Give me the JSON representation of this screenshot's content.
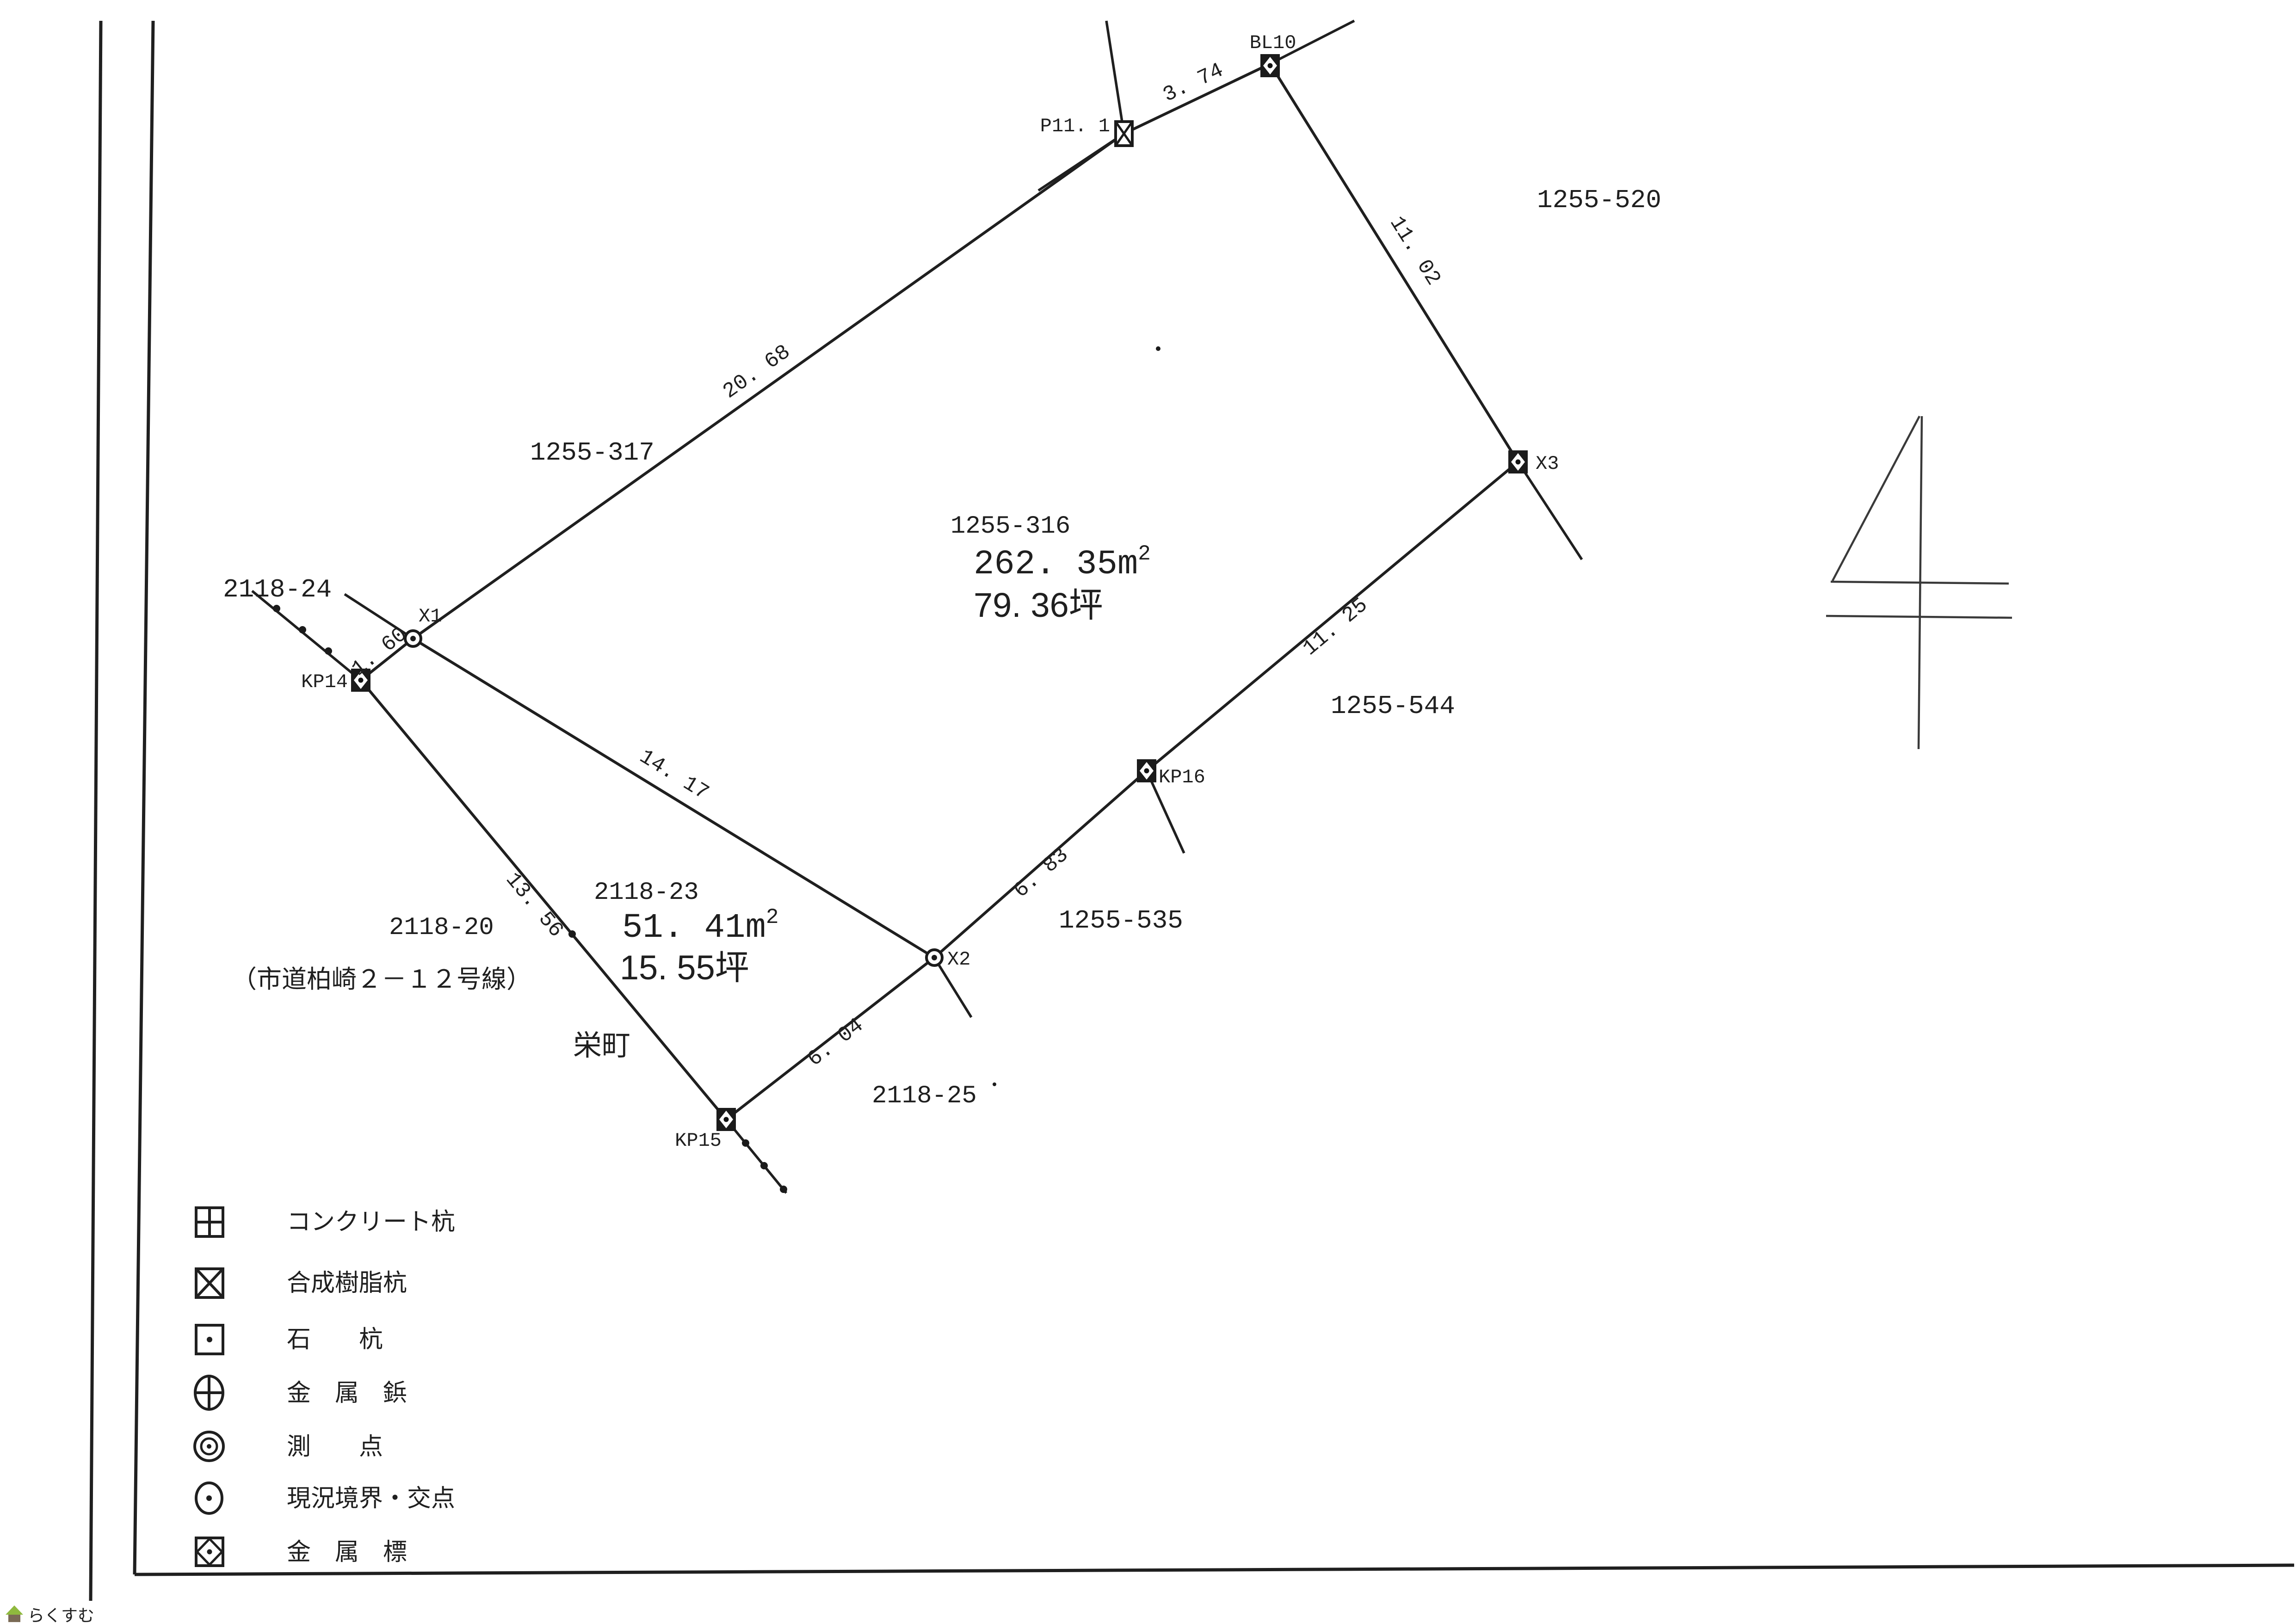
{
  "page": {
    "watermark_text": "らくすむ",
    "hand_drawn_numeral": "4"
  },
  "colors": {
    "ink": "#1f1f1f",
    "paper": "#ffffff",
    "watermark_green": "#8fb93e",
    "watermark_brown": "#7a6a55",
    "watermark_text": "#93887a"
  },
  "parcels": {
    "main": {
      "number": "1255-316",
      "area_value": "262. 35",
      "area_unit_base": "m",
      "area_unit_sup": "2",
      "area_tsubo": "79. 36坪"
    },
    "sub": {
      "number": "2118-23",
      "area_value": "51. 41",
      "area_unit_base": "m",
      "area_unit_sup": "2",
      "area_tsubo": "15. 55坪"
    }
  },
  "neighbor_parcels": {
    "n1255_520": "1255-520",
    "n1255_317": "1255-317",
    "n1255_544": "1255-544",
    "n1255_535": "1255-535",
    "n2118_24": "2118-24",
    "n2118_20": "2118-20",
    "n2118_25": "2118-25"
  },
  "road_label": "（市道柏崎２－１２号線）",
  "district_label": "栄町",
  "points": {
    "p11_1": "P11. 1",
    "bl10": "BL10",
    "x1": "X1",
    "x2": "X2",
    "x3": "X3",
    "kp14": "KP14",
    "kp15": "KP15",
    "kp16": "KP16"
  },
  "distances": {
    "d_x1_p111": "20. 68",
    "d_p111_bl10": "3. 74",
    "d_bl10_x3": "11. 02",
    "d_x3_kp16": "11. 25",
    "d_kp16_x2": "6. 83",
    "d_x1_x2": "14. 17",
    "d_x2_kp15": "6. 04",
    "d_kp14_kp15": "13. 56",
    "d_kp14_x1": "1. 60"
  },
  "legend": {
    "items": [
      {
        "icon": "concrete-pile-icon",
        "label": "コンクリート杭"
      },
      {
        "icon": "resin-pile-icon",
        "label": "合成樹脂杭"
      },
      {
        "icon": "stone-pile-icon",
        "label": "石　　杭"
      },
      {
        "icon": "metal-pin-icon",
        "label": "金　属　鋲"
      },
      {
        "icon": "survey-point-icon",
        "label": "測　　点"
      },
      {
        "icon": "boundary-intersection-icon",
        "label": "現況境界・交点"
      },
      {
        "icon": "metal-marker-icon",
        "label": "金　属　標"
      }
    ]
  }
}
